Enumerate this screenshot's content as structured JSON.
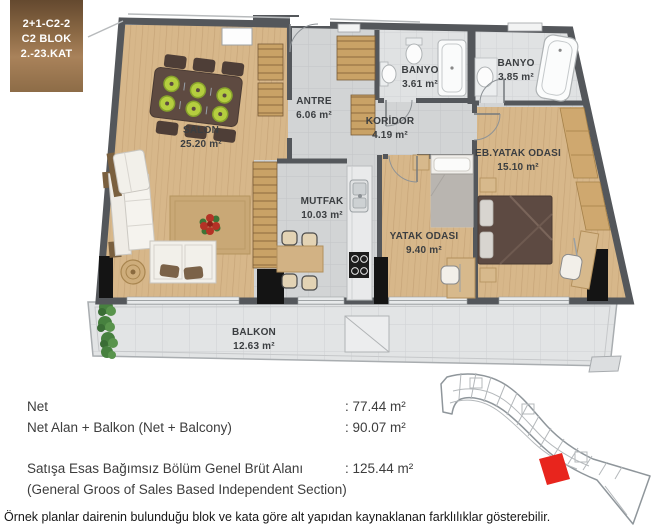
{
  "badge": {
    "lines": [
      "2+1-C2-2",
      "C2 BLOK",
      "2.-23.KAT"
    ]
  },
  "floor_plan": {
    "rooms": [
      {
        "key": "salon",
        "name": "SALON",
        "area": "25.20 m²"
      },
      {
        "key": "antre",
        "name": "ANTRE",
        "area": "6.06 m²"
      },
      {
        "key": "banyo_1",
        "name": "BANYO",
        "area": "3.61 m²"
      },
      {
        "key": "banyo_2",
        "name": "BANYO",
        "area": "3.85 m²"
      },
      {
        "key": "koridor",
        "name": "KORİDOR",
        "area": "4.19 m²"
      },
      {
        "key": "mutfak",
        "name": "MUTFAK",
        "area": "10.03 m²"
      },
      {
        "key": "yatak_odasi",
        "name": "YATAK ODASI",
        "area": "9.40 m²"
      },
      {
        "key": "eb_yatak_odasi",
        "name": "EB.YATAK ODASI",
        "area": "15.10 m²"
      },
      {
        "key": "balkon",
        "name": "BALKON",
        "area": "12.63 m²"
      }
    ]
  },
  "summary": {
    "rows": [
      {
        "label": "Net",
        "value": ": 77.44 m²"
      },
      {
        "label": "Net Alan + Balkon (Net + Balcony)",
        "value": ": 90.07 m²"
      },
      {
        "label": "Satışa Esas Bağımsız Bölüm Genel Brüt Alanı",
        "value": ": 125.44 m²"
      },
      {
        "label": "(General Groos of Sales Based Independent Section)",
        "value": ""
      }
    ]
  },
  "disclaimer": "Örnek planlar dairenin bulunduğu blok ve kata göre alt yapıdan kaynaklanan farklılıklar gösterebilir.",
  "site_plan": {
    "highlighted_unit_color": "#e8251d"
  },
  "colors": {
    "wall": "#54575b",
    "wood_floor": "#d7b78a",
    "tile_floor": "#d2d4d5",
    "balcony_floor": "#e2e4e5",
    "accent_red": "#e8251d",
    "badge_dark": "#64492f",
    "badge_light": "#a9825a"
  }
}
